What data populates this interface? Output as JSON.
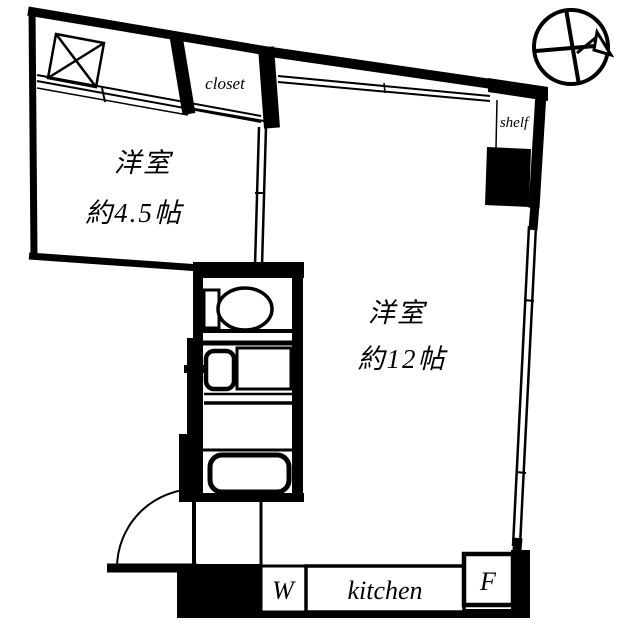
{
  "labels": {
    "room_small_name": "洋室",
    "room_small_size": "約4.5帖",
    "room_large_name": "洋室",
    "room_large_size": "約12帖",
    "closet": "closet",
    "shelf": "shelf",
    "washer": "W",
    "kitchen": "kitchen",
    "fridge": "F"
  },
  "fixtures": {
    "compass": "compass-north-icon",
    "toilet": "toilet-icon",
    "washbasin": "washbasin-icon",
    "bathtub": "bathtub-icon",
    "entrance_door": "door-swing-arc-icon",
    "storage_box": "crossed-box-icon"
  },
  "colors": {
    "wall": "#000000",
    "background": "#ffffff"
  }
}
